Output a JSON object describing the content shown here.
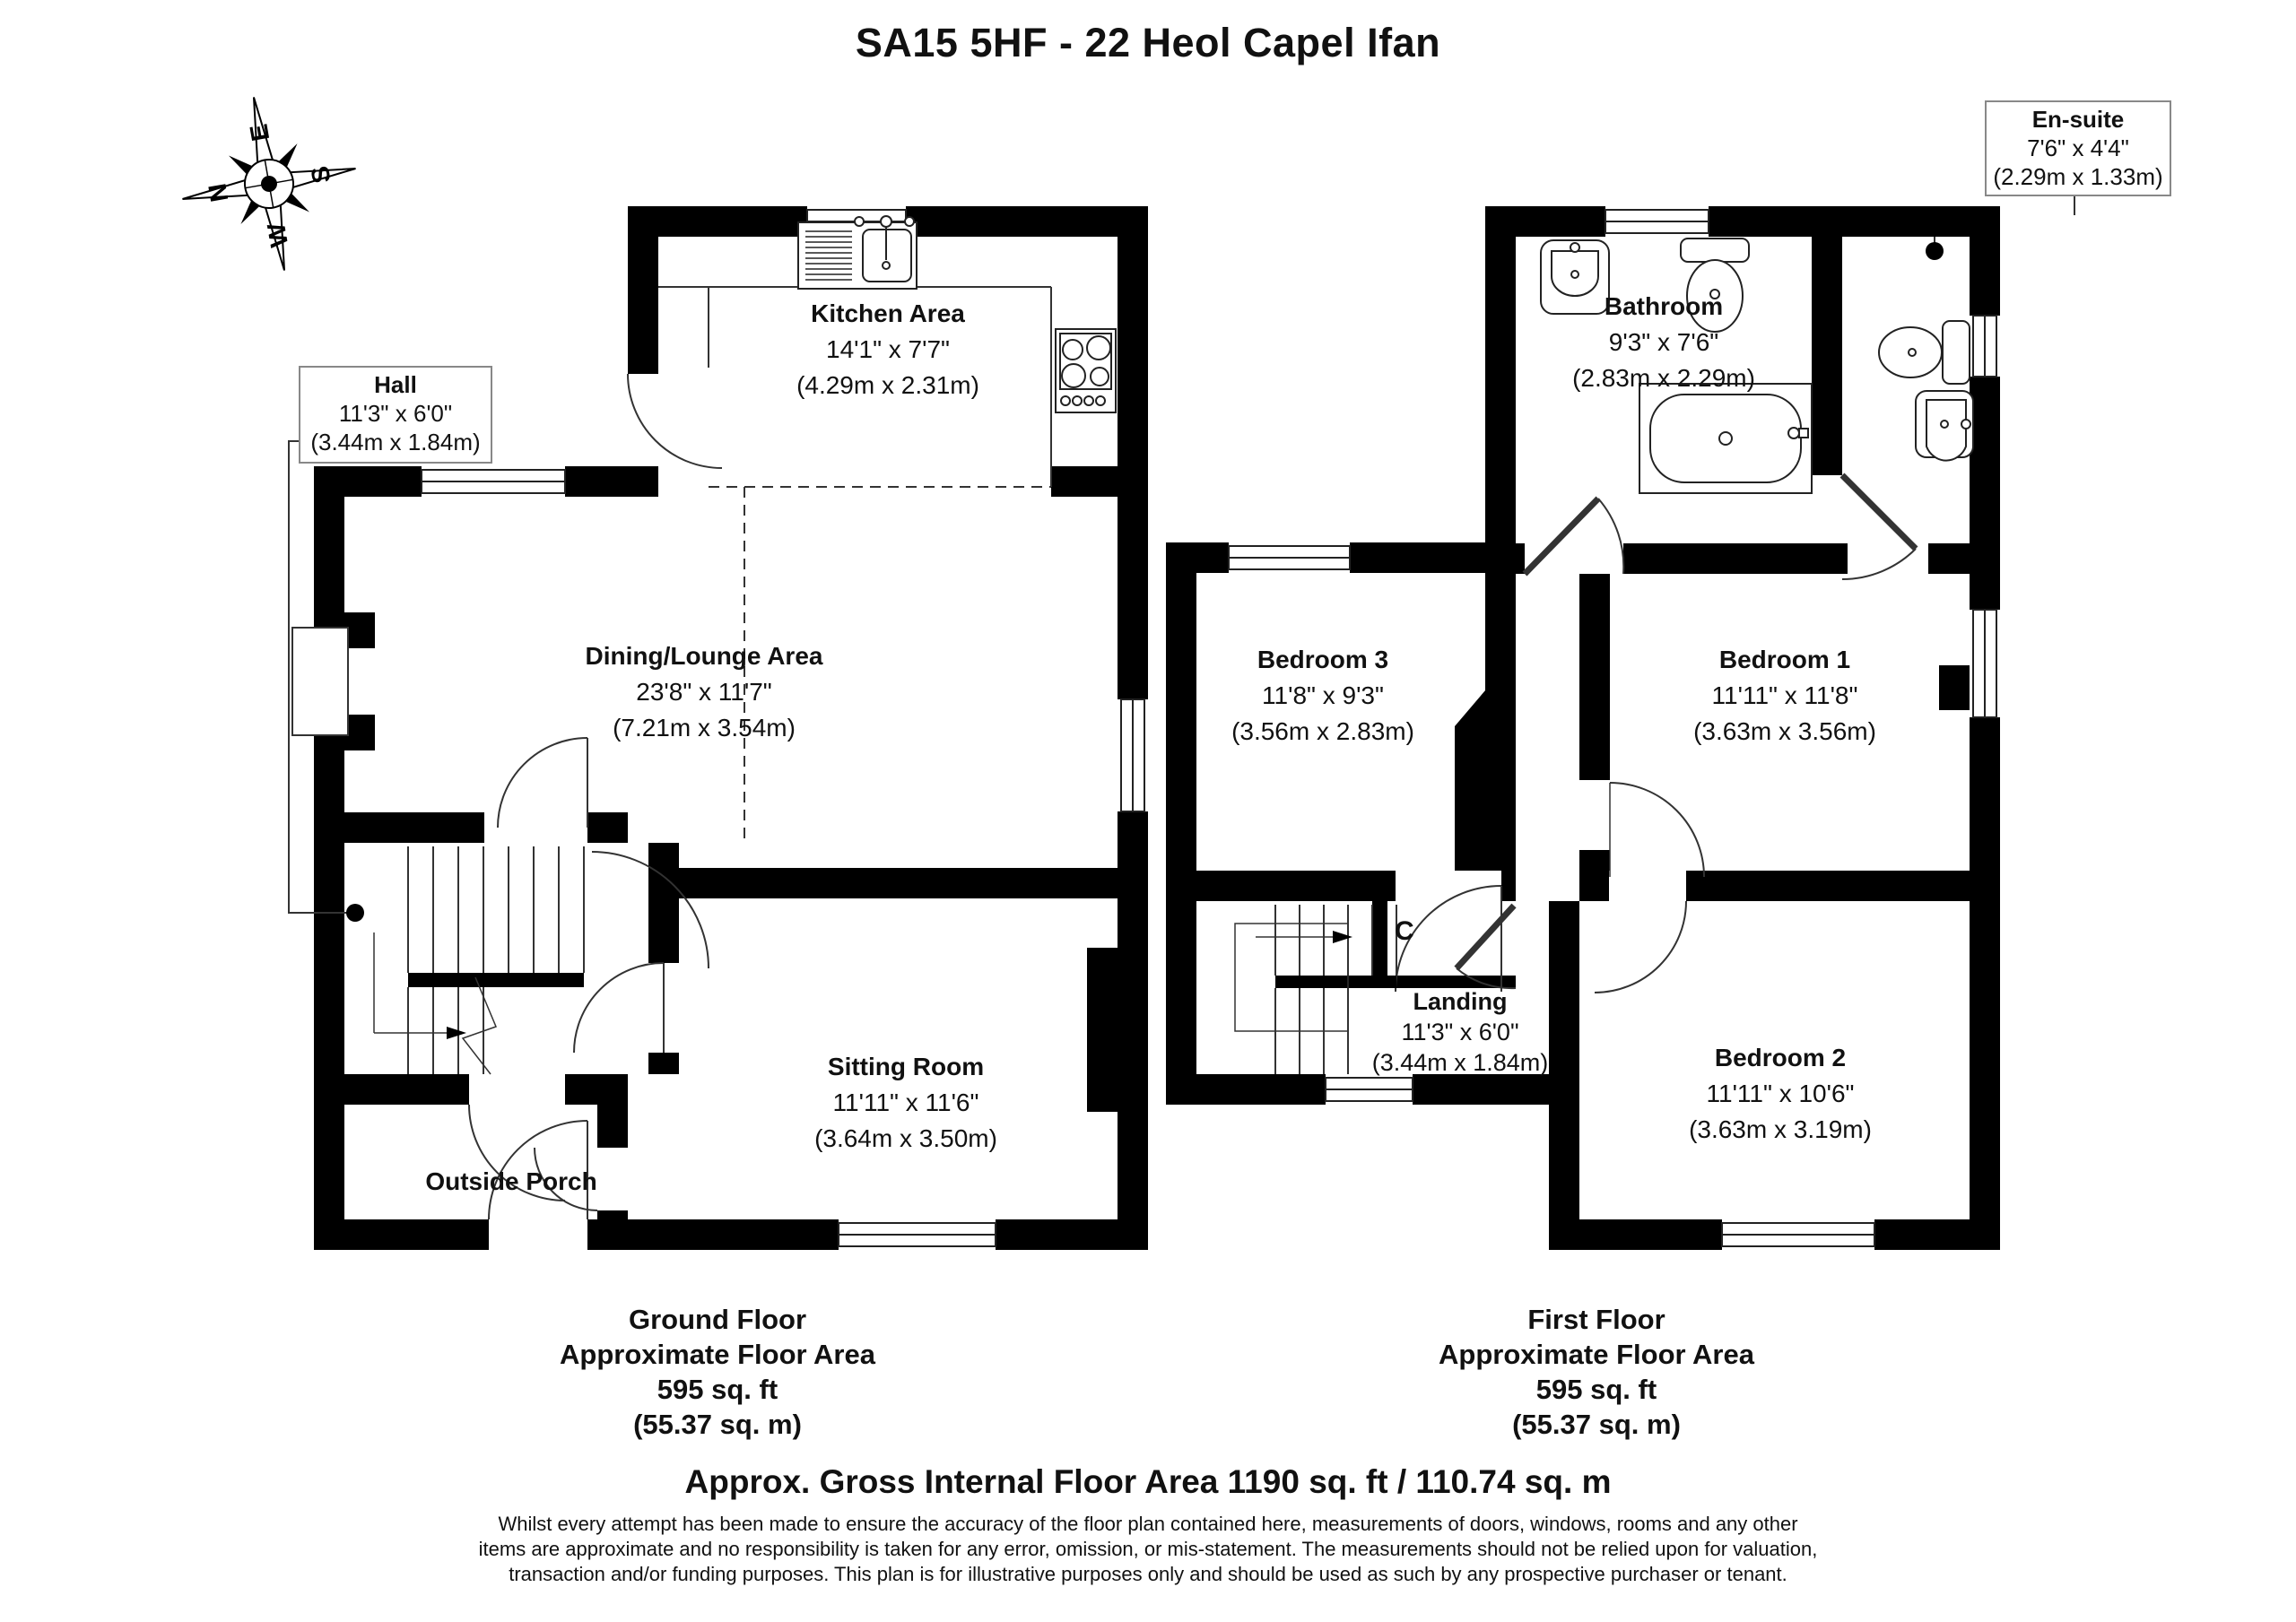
{
  "title": "SA15 5HF - 22 Heol Capel Ifan",
  "compass": {
    "n": "N",
    "e": "E",
    "s": "S",
    "w": "W"
  },
  "ground_floor": {
    "hall": {
      "name": "Hall",
      "imperial": "11'3\" x 6'0\"",
      "metric": "(3.44m x 1.84m)"
    },
    "kitchen": {
      "name": "Kitchen Area",
      "imperial": "14'1\" x 7'7\"",
      "metric": "(4.29m x 2.31m)"
    },
    "dining": {
      "name": "Dining/Lounge Area",
      "imperial": "23'8\" x 11'7\"",
      "metric": "(7.21m x 3.54m)"
    },
    "sitting": {
      "name": "Sitting Room",
      "imperial": "11'11\" x 11'6\"",
      "metric": "(3.64m x 3.50m)"
    },
    "porch": {
      "name": "Outside Porch"
    },
    "caption": [
      "Ground Floor",
      "Approximate Floor Area",
      "595 sq. ft",
      "(55.37 sq. m)"
    ]
  },
  "first_floor": {
    "bathroom": {
      "name": "Bathroom",
      "imperial": "9'3\" x 7'6\"",
      "metric": "(2.83m x 2.29m)"
    },
    "ensuite": {
      "name": "En-suite",
      "imperial": "7'6\" x 4'4\"",
      "metric": "(2.29m x 1.33m)"
    },
    "bedroom1": {
      "name": "Bedroom 1",
      "imperial": "11'11\" x 11'8\"",
      "metric": "(3.63m x 3.56m)"
    },
    "bedroom2": {
      "name": "Bedroom 2",
      "imperial": "11'11\" x 10'6\"",
      "metric": "(3.63m x 3.19m)"
    },
    "bedroom3": {
      "name": "Bedroom 3",
      "imperial": "11'8\" x 9'3\"",
      "metric": "(3.56m x 2.83m)"
    },
    "landing": {
      "name": "Landing",
      "imperial": "11'3\" x 6'0\"",
      "metric": "(3.44m x 1.84m)"
    },
    "cupboard": "C",
    "caption": [
      "First Floor",
      "Approximate Floor Area",
      "595 sq. ft",
      "(55.37 sq. m)"
    ]
  },
  "footer": {
    "gross": "Approx. Gross Internal Floor Area 1190 sq. ft / 110.74 sq. m",
    "disclaimer": "Whilst every attempt has been made to ensure the accuracy of the floor plan contained here, measurements of doors, windows, rooms and any other items are approximate and no responsibility is taken for any error, omission, or mis-statement. The measurements should not be relied upon for valuation, transaction and/or funding purposes. This plan is for illustrative purposes only and should be used as such by any prospective purchaser or tenant."
  }
}
